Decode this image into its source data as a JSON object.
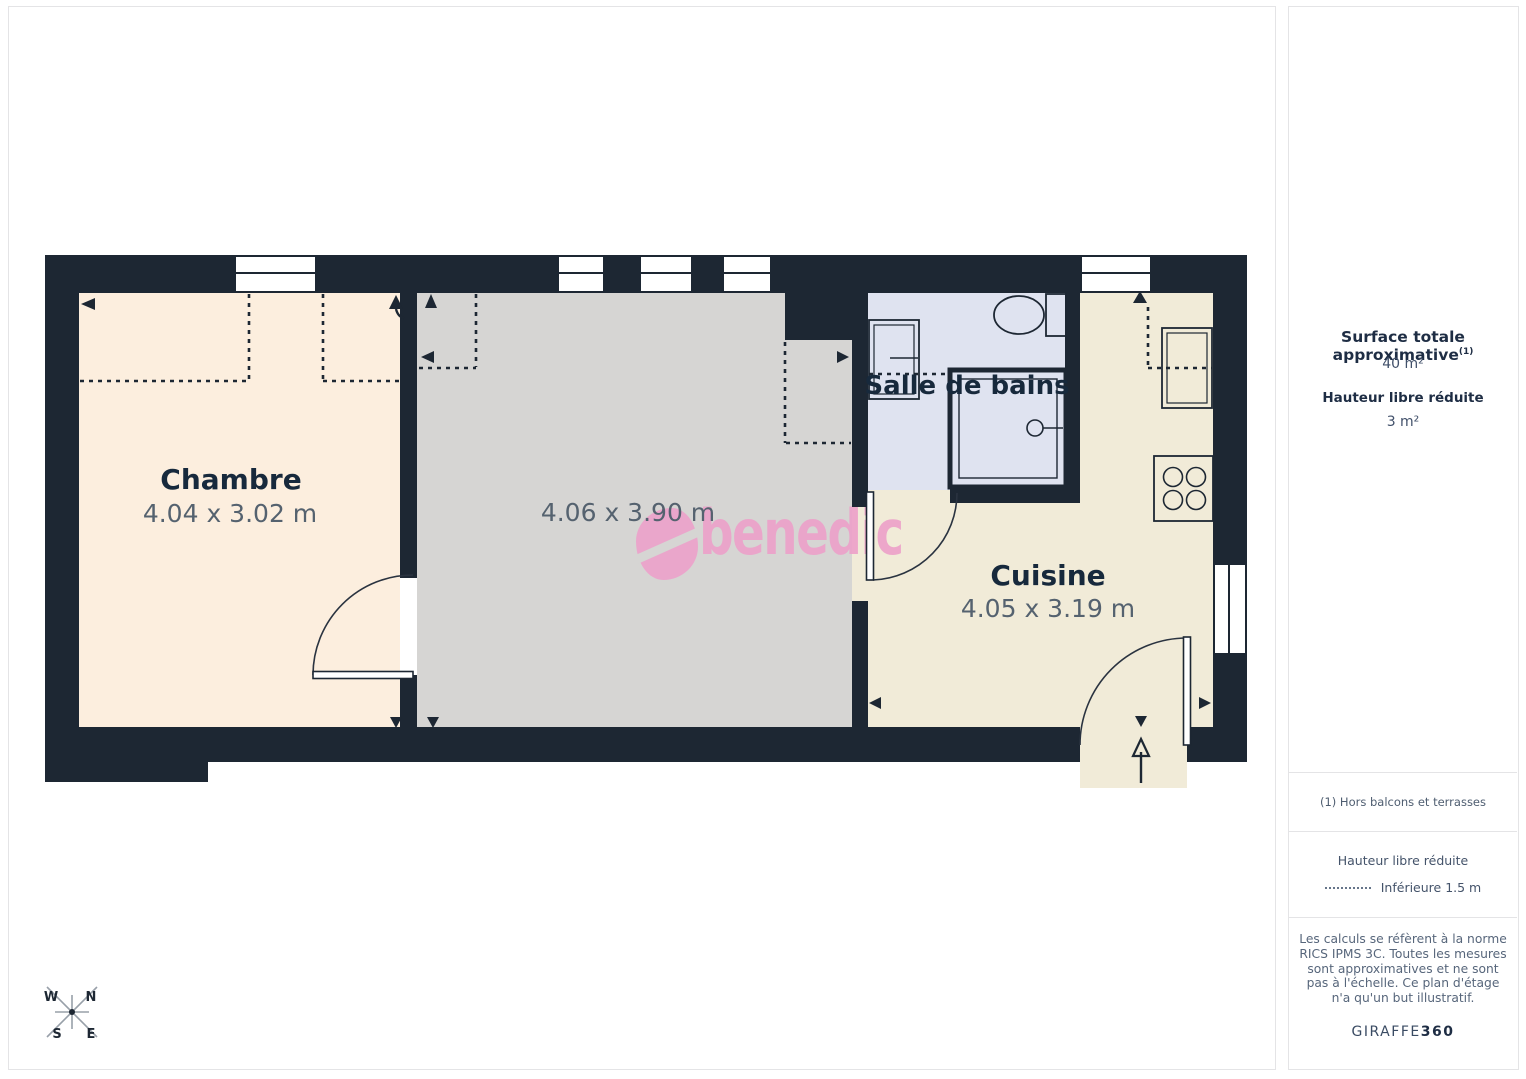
{
  "plan": {
    "rooms": {
      "chambre": {
        "name": "Chambre",
        "dims": "4.04 x 3.02 m"
      },
      "sejour": {
        "dims": "4.06 x 3.90 m"
      },
      "bains": {
        "name": "Salle de bains"
      },
      "cuisine": {
        "name": "Cuisine",
        "dims": "4.05 x 3.19 m"
      }
    },
    "watermark": {
      "text": "benedic"
    },
    "compass": {
      "w": "W",
      "n": "N",
      "s": "S",
      "e": "E"
    }
  },
  "sidebar": {
    "surface_title": "Surface totale approximative",
    "surface_sup": "(1)",
    "surface_value": "40 m²",
    "reduced_title": "Hauteur libre réduite",
    "reduced_value": "3 m²",
    "footnote": "(1) Hors balcons et terrasses",
    "legend_title": "Hauteur libre réduite",
    "legend_item": "Inférieure 1.5 m",
    "disclaimer": "Les calculs se réfèrent à la norme RICS IPMS 3C. Toutes les mesures sont approximatives et ne sont pas à l'échelle. Ce plan d'étage n'a qu'un but illustratif.",
    "brand": "GIRAFFE",
    "brand_bold": "360"
  },
  "colors": {
    "wall": "#1d2733",
    "floor_chambre": "#fceede",
    "floor_sejour": "#d6d5d3",
    "floor_bains": "#dfe3f0",
    "floor_cuisine": "#f1ebd8",
    "accent_pink": "#eca3cb",
    "label_text": "#17293c",
    "dims_text": "#55626f"
  }
}
